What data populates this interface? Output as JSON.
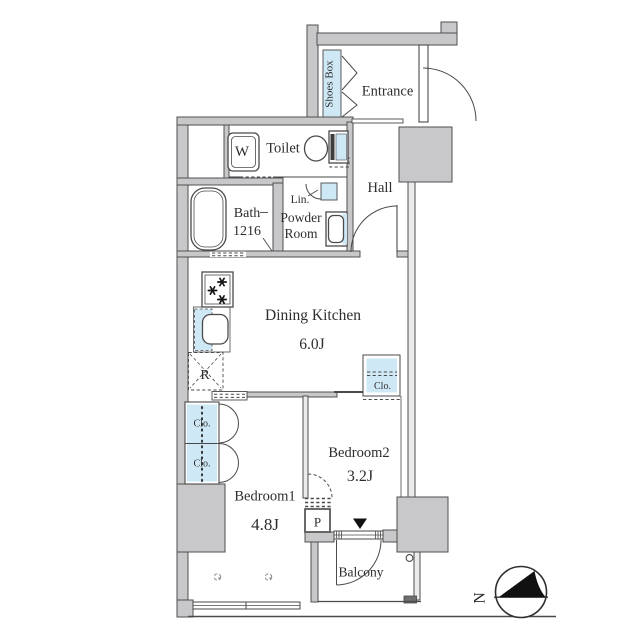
{
  "title": "2DK apartment floor plan",
  "colors": {
    "wall_fill": "#c8c8ca",
    "wall_light": "#ebebec",
    "fixture_blue": "#cfe8f5",
    "line": "#4a4a4a",
    "text": "#2d2d2d",
    "marker_dark": "#6f6f71"
  },
  "rooms": {
    "shoes_box": {
      "label": "Shoes Box"
    },
    "entrance": {
      "label": "Entrance"
    },
    "toilet": {
      "label": "Toilet"
    },
    "washer": {
      "label": "W"
    },
    "hall": {
      "label": "Hall"
    },
    "bath": {
      "label": "Bath",
      "dim": "1216"
    },
    "linen": {
      "label": "Lin."
    },
    "powder": {
      "line1": "Powder",
      "line2": "Room"
    },
    "dk": {
      "label": "Dining Kitchen",
      "size": "6.0J"
    },
    "fridge": {
      "label": "R"
    },
    "closet_left_top": {
      "label": "Clo."
    },
    "closet_left_bottom": {
      "label": "Clo."
    },
    "closet_bedroom2": {
      "label": "Clo."
    },
    "bedroom1": {
      "label": "Bedroom1",
      "size": "4.8J"
    },
    "bedroom2": {
      "label": "Bedroom2",
      "size": "3.2J"
    },
    "pipe": {
      "label": "P"
    },
    "balcony": {
      "label": "Balcony"
    }
  },
  "compass": {
    "north": "N"
  }
}
